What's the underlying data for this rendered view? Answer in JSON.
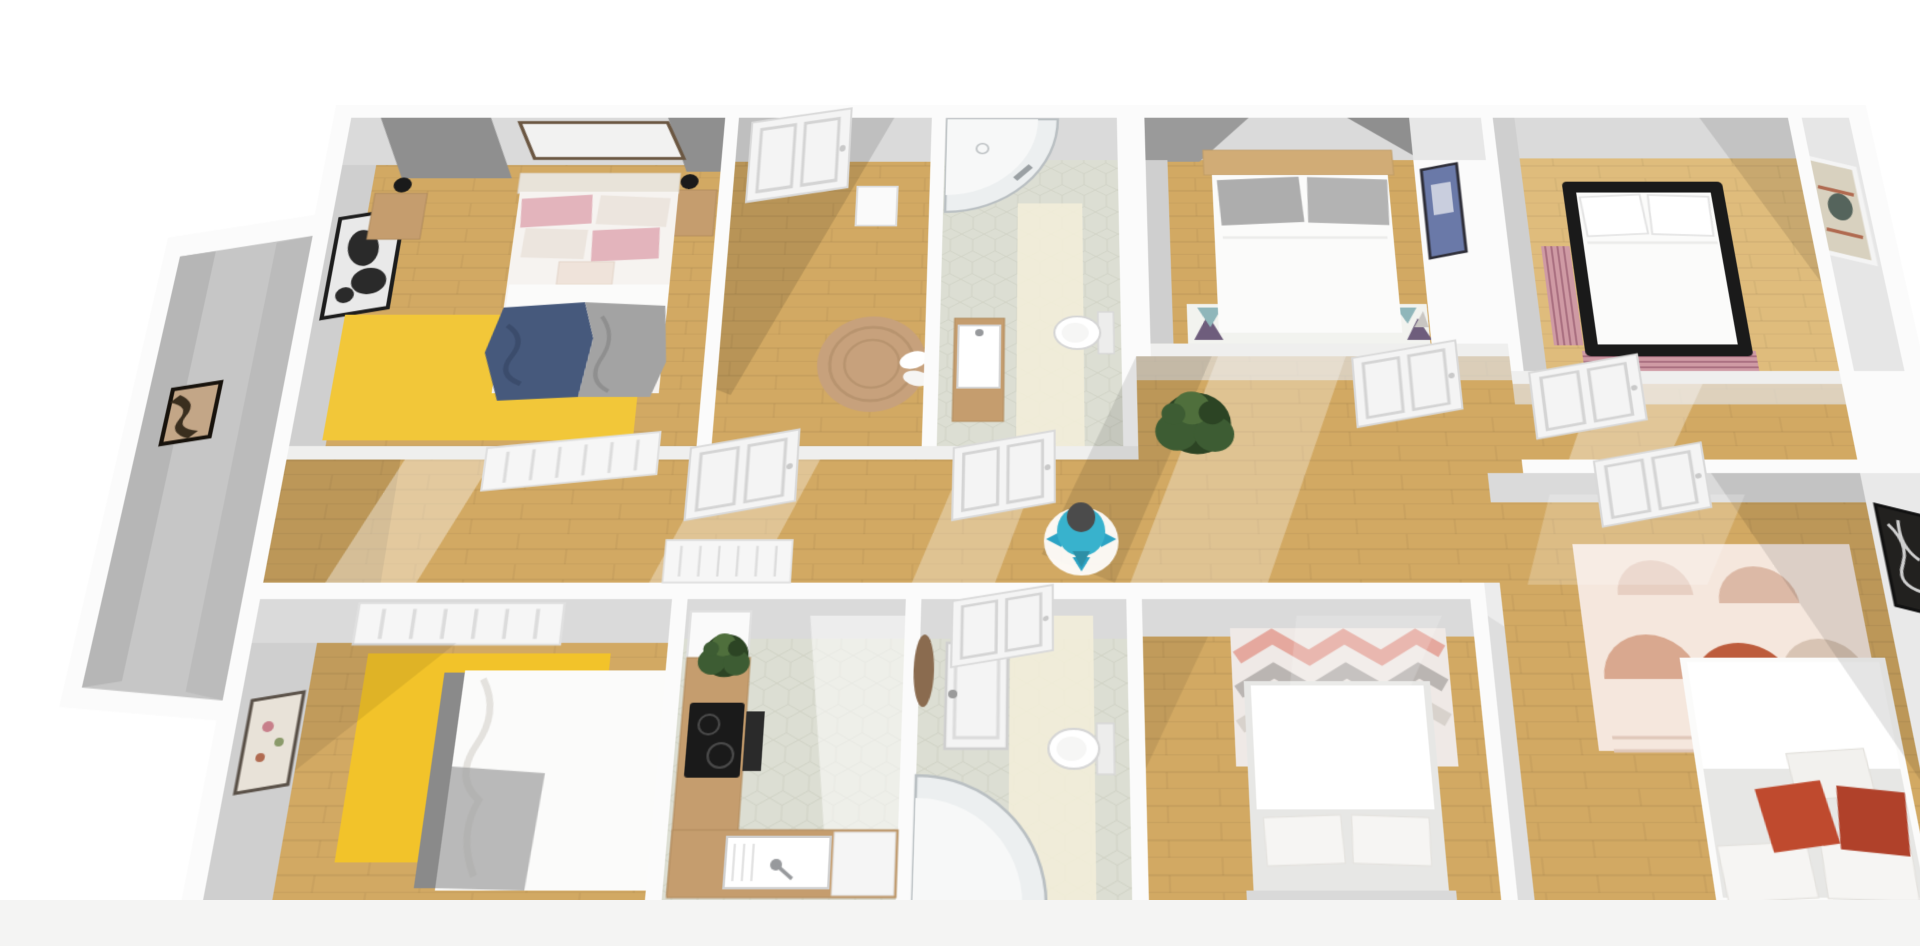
{
  "app": {
    "name": "3d-floor-plan-view",
    "background": "#ffffff",
    "footer_strip": "#f4f4f3"
  },
  "plan": {
    "projection": {
      "perspective_px": 1960,
      "rotate_x_deg": 26,
      "scale": 1.08
    }
  },
  "palette": {
    "wallWhite": "#fbfbfb",
    "wallLit": "#efefee",
    "faceLight": "#dadada",
    "faceMid": "#cfcfcf",
    "faceDark": "#9a9a9a",
    "wedge": "#8f8f8f",
    "wood": "#d2a963",
    "woodLight": "#dfbc7c",
    "tile": "#dcded3",
    "tileLight": "#f3efd9",
    "grayFloor": "#c6c6c6",
    "rugYellow": "#f2c32a",
    "rugJute": "#c7a17c",
    "rugChevronBase": "#efe9e6",
    "chevronPink": "#e5a89e",
    "chevronGray": "#bab5b2",
    "bohoBase": "#f5e7dd",
    "bohoRust": "#bd5c3c",
    "bohoPink": "#d9a88f",
    "bohoSand": "#d8c4b4",
    "stripeRug": "#cf9aa4",
    "stripeRugDark": "#a96f80",
    "bedWhite": "#fbfbfa",
    "sheet": "#f6f3f0",
    "duvetGray": "#e7e7e5",
    "pillowPink": "#e3b4bc",
    "pillowDot": "#ece5de",
    "pillowGray": "#adadad",
    "pillowWhite": "#f6f5f3",
    "headboardCream": "#e8e3d9",
    "headboardWood": "#d1ac76",
    "headboardGray": "#8a8a8a",
    "blanketNavy": "#46597c",
    "blanketGray": "#a3a3a3",
    "furnWood": "#c59d6e",
    "black": "#1a1a1a",
    "dark": "#2a2a2a",
    "white": "#ffffff",
    "offWhite": "#f4f4f4",
    "steel": "#97999c",
    "glass": "#eceff0",
    "tray": "#f7f8f8",
    "artTan": "#c3a687",
    "artBlue": "#6a79a8",
    "artPortraitBg": "#d8d1bf",
    "artDark": "#22211f",
    "green": "#3d5c33",
    "greenDark": "#2c4424",
    "greenLight": "#4f6f3c",
    "teal": "#38b2cd",
    "tealArrow": "#2ba3c4",
    "headGray": "#4b4b4b",
    "red": "#bf4a2e",
    "redDark": "#b0412a",
    "triTeal": "#8fb6ba",
    "triPurple": "#6e5d7c",
    "triGray": "#c9c6c2"
  },
  "rooms": [
    {
      "id": "bedroom-top-left",
      "floor": "wood",
      "furniture": [
        "double-bed-pink-bedding",
        "navy-blanket",
        "gray-blanket",
        "yellow-rug",
        "nightstand-left",
        "nightstand-right",
        "wall-lamps",
        "wall-art-abstract-black",
        "wall-frame-above-bed"
      ]
    },
    {
      "id": "room-top-mid-left",
      "floor": "wood",
      "furniture": [
        "white-paneled-door",
        "small-white-desk",
        "round-jute-rug",
        "white-towels"
      ]
    },
    {
      "id": "bathroom-top",
      "floor": "hex-tile",
      "furniture": [
        "corner-shower",
        "wood-vanity-with-sink",
        "toilet"
      ]
    },
    {
      "id": "bedroom-top-mid-right",
      "floor": "wood",
      "furniture": [
        "double-bed-gray-pillows",
        "triangle-pattern-rug",
        "wall-art-blue"
      ]
    },
    {
      "id": "bedroom-top-right",
      "floor": "wood",
      "furniture": [
        "black-frame-bed",
        "striped-runner-rug",
        "wall-art-portrait"
      ]
    },
    {
      "id": "left-wing-room",
      "floor": "gray",
      "furniture": [
        "wall-art-tan-abstract"
      ]
    },
    {
      "id": "hallway",
      "floor": "wood",
      "furniture": [
        "potted-plant",
        "person-marker",
        "radiator-panels",
        "white-paneled-doors"
      ]
    },
    {
      "id": "bedroom-bottom-left",
      "floor": "wood",
      "furniture": [
        "double-bed-white-gray-throw",
        "yellow-rug",
        "wall-art-floral",
        "window-radiator"
      ]
    },
    {
      "id": "kitchen",
      "floor": "hex-tile",
      "furniture": [
        "l-shaped-wood-counter",
        "black-cooktop",
        "oven",
        "sink-with-faucet",
        "potted-plant",
        "white-cabinet"
      ]
    },
    {
      "id": "bathroom-bottom",
      "floor": "hex-tile",
      "furniture": [
        "white-shower-door-panel",
        "round-wood-mirror",
        "toilet",
        "corner-shower"
      ]
    },
    {
      "id": "bedroom-bottom-mid",
      "floor": "wood",
      "furniture": [
        "double-bed-white",
        "chevron-rug",
        "wall-art-bw-photo"
      ]
    },
    {
      "id": "bedroom-bottom-right",
      "floor": "wood",
      "furniture": [
        "double-bed-white",
        "red-accent-cushions",
        "boho-arch-rug",
        "wall-art-dark-abstract"
      ]
    }
  ],
  "figures": {
    "person_marker": {
      "shirt": "#38b2cd",
      "base": "#ffffff",
      "arrows": "#2ba3c4",
      "head": "#4b4b4b"
    }
  }
}
